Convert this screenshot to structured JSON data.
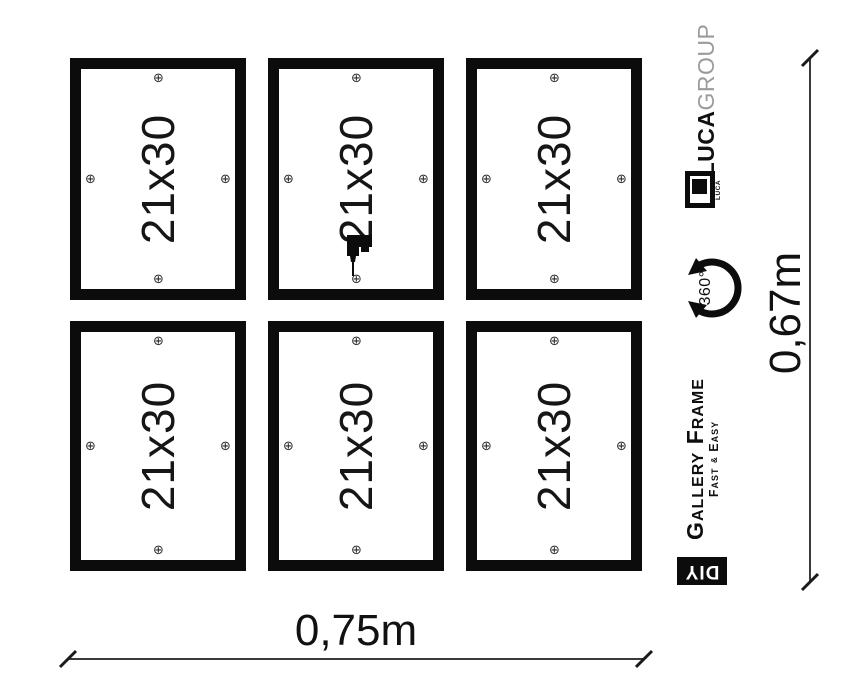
{
  "canvas": {
    "background": "#ffffff",
    "ink": "#111111"
  },
  "grid": {
    "rows": 2,
    "cols": 3
  },
  "frames": [
    {
      "label": "21x30",
      "drill": false
    },
    {
      "label": "21x30",
      "drill": true
    },
    {
      "label": "21x30",
      "drill": false
    },
    {
      "label": "21x30",
      "drill": false
    },
    {
      "label": "21x30",
      "drill": false
    },
    {
      "label": "21x30",
      "drill": false
    }
  ],
  "icons": {
    "screw_glyph": "⊕"
  },
  "dimensions": {
    "width": {
      "label": "0,75m"
    },
    "height": {
      "label": "0,67m"
    }
  },
  "sidebar": {
    "brand": {
      "primary": "LUCA",
      "secondary": "GROUP"
    },
    "logo": {
      "caption": "LUCA"
    },
    "rotation_badge": {
      "label": "360°"
    },
    "product": {
      "title": "Gallery Frame",
      "subtitle_fast": "Fast",
      "subtitle_amp": "&",
      "subtitle_easy": "Easy"
    },
    "diy": {
      "label": "DIY"
    }
  },
  "colors": {
    "frame_border": "#0c0c0c",
    "text": "#1a1a1a",
    "brand_gray": "#9b9b9b",
    "dimension_line": "#3a3a3a"
  }
}
